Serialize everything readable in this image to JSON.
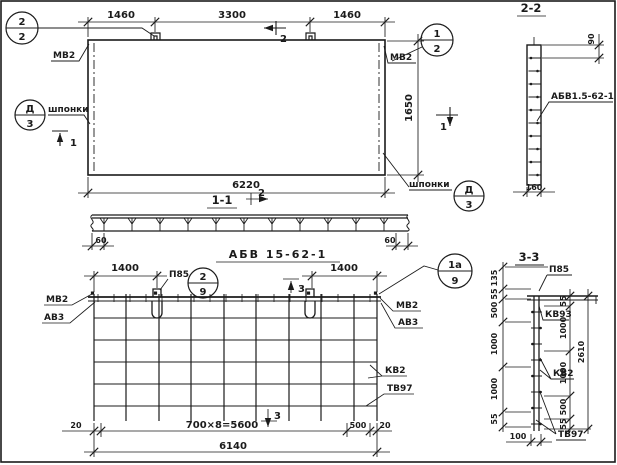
{
  "plan": {
    "dim_1460_left": "1460",
    "dim_3300": "3300",
    "dim_1460_right": "1460",
    "dim_6220": "6220",
    "dim_1650": "1650",
    "label_mv2_left": "МВ2",
    "label_mv2_right": "МВ2",
    "label_shponki_left": "шпонки",
    "label_shponki_right": "шпонки",
    "callout_22": {
      "top": "2",
      "bottom": "2"
    },
    "callout_12": {
      "top": "1",
      "bottom": "2"
    },
    "callout_d3_left": {
      "top": "Д",
      "bottom": "3"
    },
    "callout_d3_right": {
      "top": "Д",
      "bottom": "3"
    },
    "mark_1_left": "1",
    "mark_1_right": "1",
    "mark_2_top": "2"
  },
  "section_2_2": {
    "title": "2-2",
    "dim_90": "90",
    "dim_160": "160",
    "label": "АБВ1.5-62-1"
  },
  "section_1_1": {
    "title": "1-1",
    "mark_2": "2",
    "dim_60_left": "60",
    "dim_60_right": "60"
  },
  "assembly": {
    "title": "АБВ 15-62-1",
    "dim_1400_left": "1400",
    "dim_1400_right": "1400",
    "label_p85": "П85",
    "callout_29": {
      "top": "2",
      "bottom": "9"
    },
    "callout_1a9": {
      "top": "1а",
      "bottom": "9"
    },
    "label_mv2_left": "МВ2",
    "label_av3_left": "АВ3",
    "label_mv2_right": "МВ2",
    "label_av3_right": "АВ3",
    "label_kv2": "КВ2",
    "label_tv97": "ТВ97",
    "mark_3_top": "3",
    "mark_3_bottom": "3",
    "dim_20_left": "20",
    "dim_700x8": "700×8=5600",
    "dim_500": "500",
    "dim_20_right": "20",
    "dim_6140": "6140"
  },
  "section_3_3": {
    "title": "3-3",
    "label_p85": "П85",
    "label_kv93": "КВ93",
    "label_kv2": "КВ2",
    "label_tv97": "ТВ97",
    "left_dims": [
      "135",
      "55",
      "500",
      "1000",
      "1000",
      "55"
    ],
    "right_dims": [
      "55",
      "1000",
      "1000",
      "500",
      "55"
    ],
    "dim_2610": "2610",
    "dim_100": "100"
  }
}
